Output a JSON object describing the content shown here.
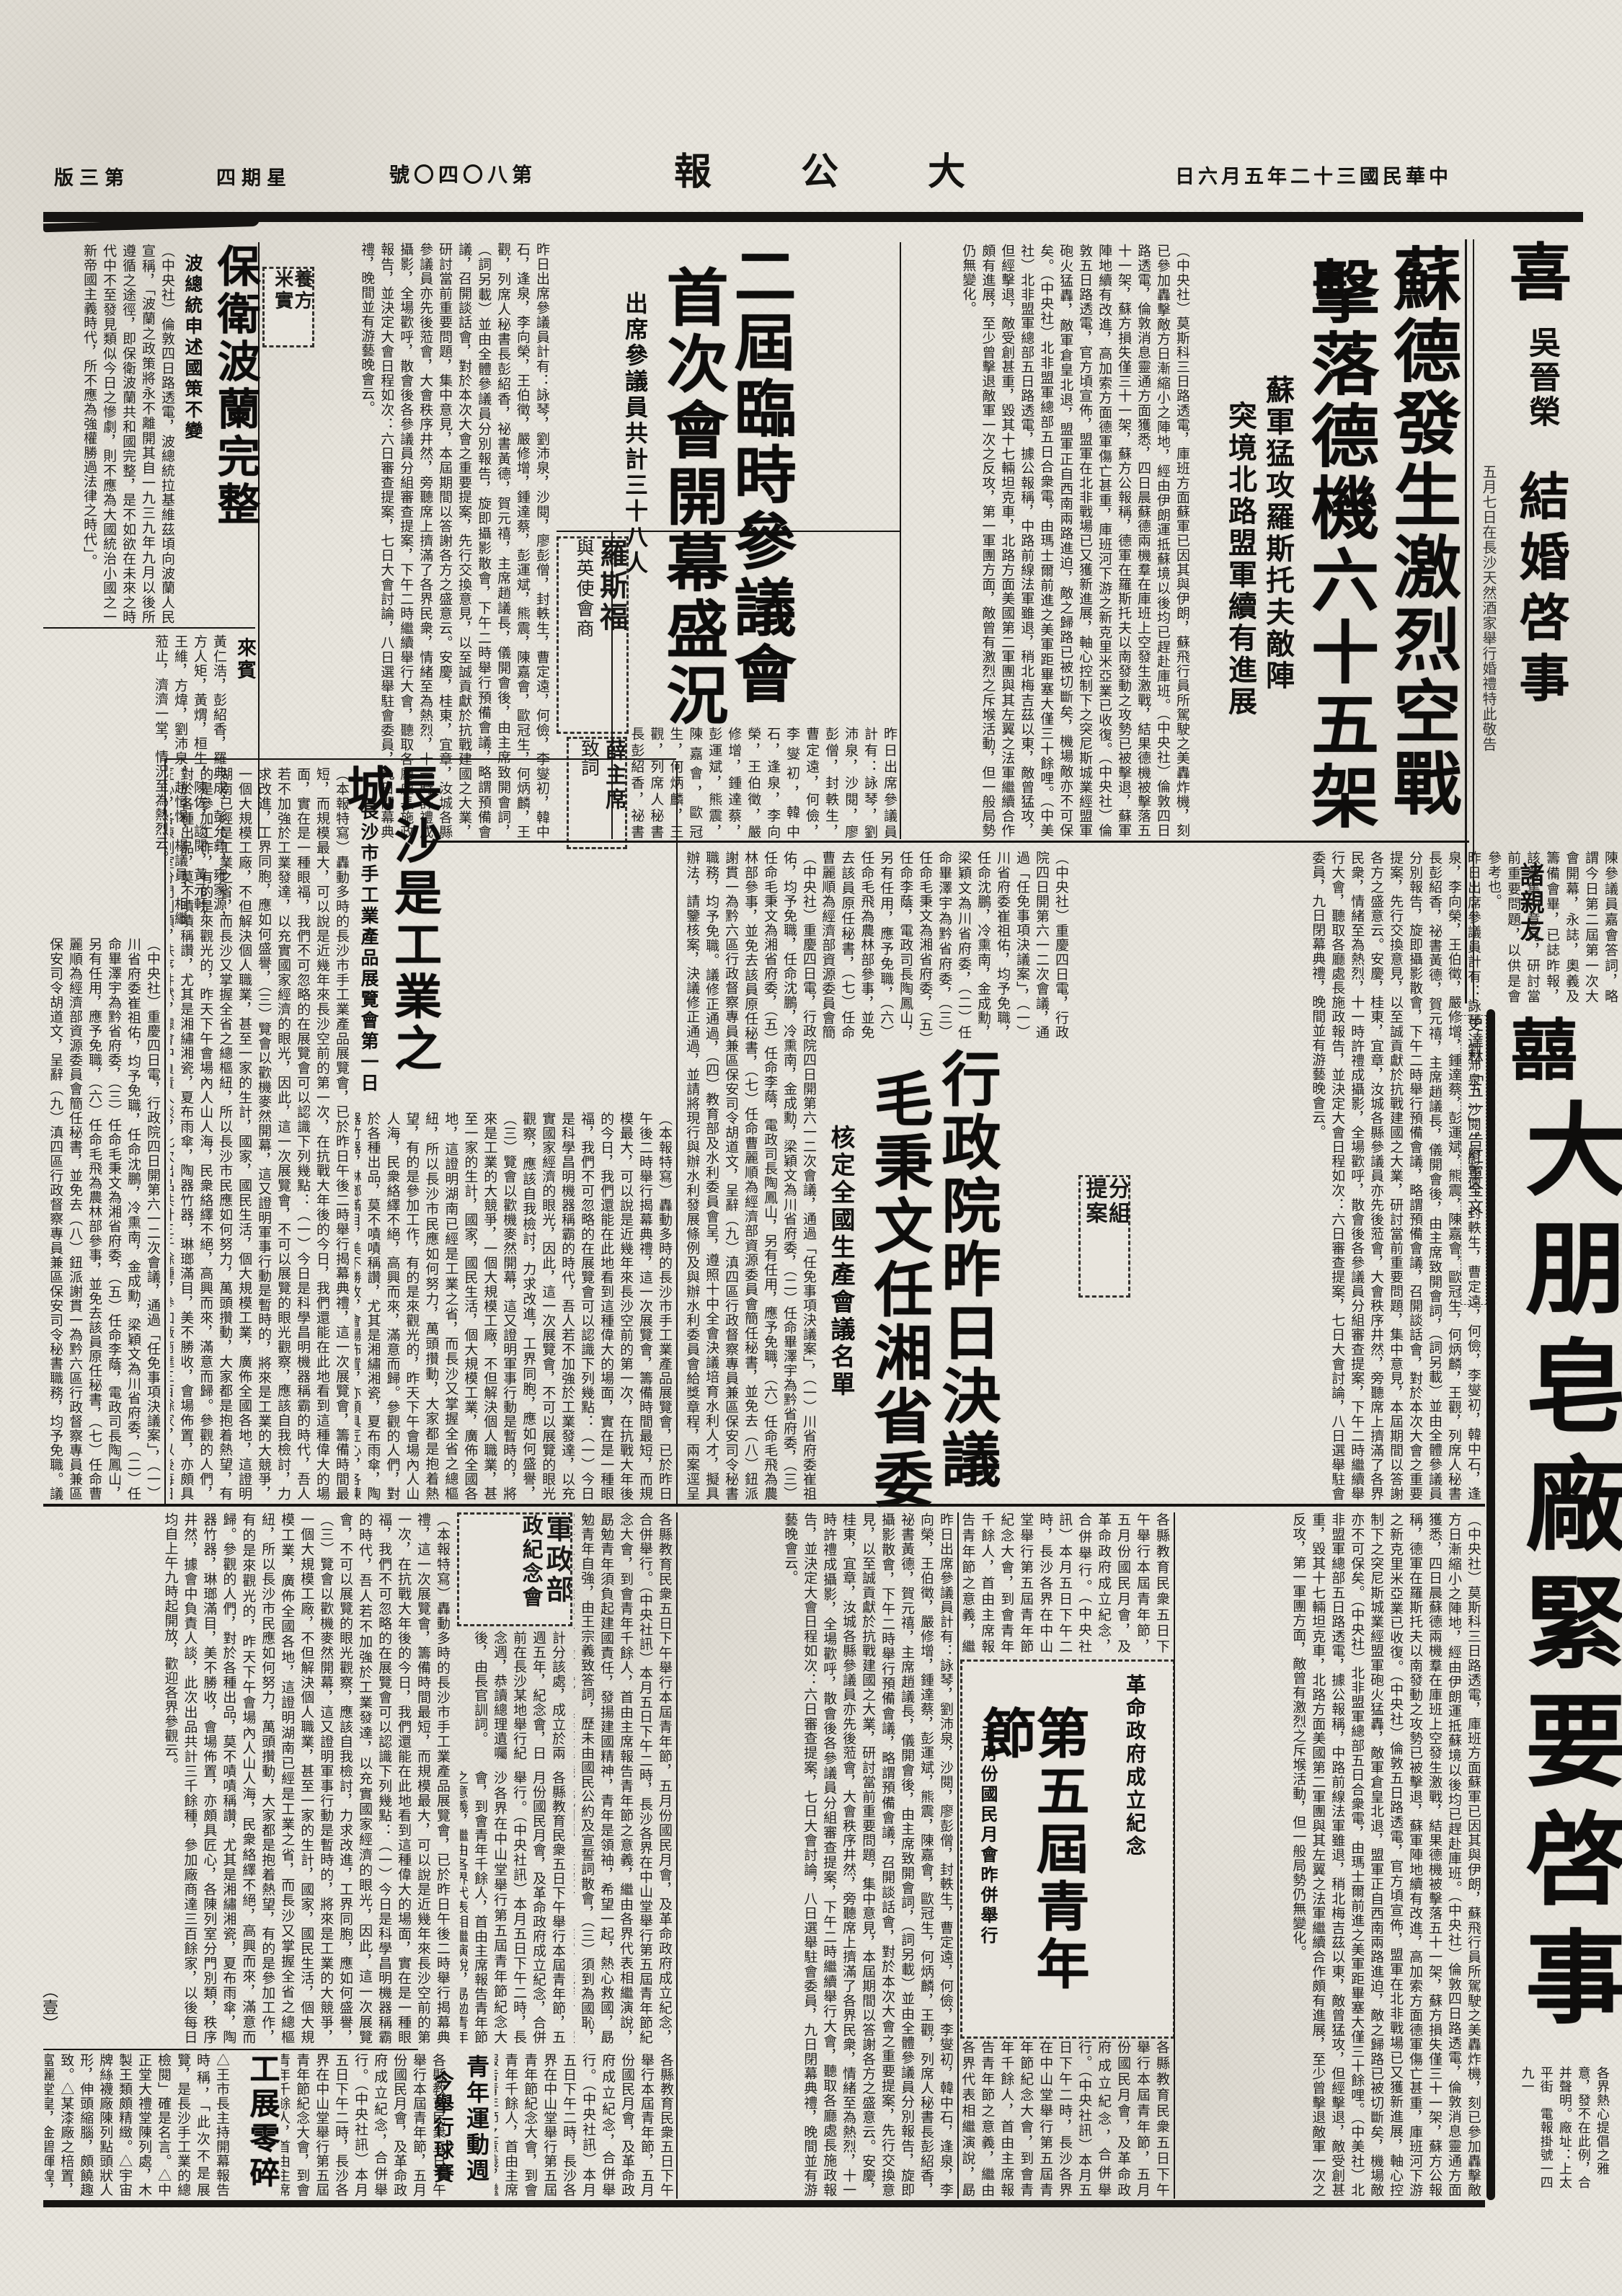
{
  "masthead": {
    "edition": "版三第",
    "weekday": "四期星",
    "issue": "號〇四〇八第",
    "title": "報　公　大",
    "date": "日六月五年二十三國民華中"
  },
  "top": {
    "wedding": {
      "joy": "喜",
      "names": "吳晉榮",
      "title": "結婚啓事",
      "note": "五月七日在長沙天然酒家舉行婚禮特此敬告",
      "addressee": "諸親友"
    },
    "sude": {
      "h1": "蘇德發生激烈空戰",
      "h2": "擊落德機六十五架",
      "sub1": "蘇軍猛攻羅斯托夫敵陣",
      "sub2": "突境北路盟軍續有進展",
      "body": "（中央社）莫斯科三日路透電，庫班方面蘇軍已因其與伊朗，蘇飛行員所駕駛之美轟炸機，刻已參加轟擊敵方日漸縮小之陣地，經由伊朗運抵蘇境以後均已趕赴庫班。（中央社）倫敦四日路透電，倫敦消息靈通方面獲悉，四日晨蘇德兩機羣在庫班上空發生激戰，結果德機被擊落五十一架，蘇方損失僅三十一架，蘇方公報稱，德軍在羅斯托夫以南發動之攻勢已被擊退，蘇軍陣地續有改進，高加索方面德軍傷亡甚重，庫班河下游之新克里米亞業已收復。（中央社）倫敦五日路透電，官方頃宣佈，盟軍在北非戰場已又獲新進展，軸心控制下之突尼斯城業經盟軍砲火猛轟，敵軍倉皇北退，盟軍正自西南兩路進迫，敵之歸路已被切斷矣，機場敵亦不可保矣。（中央社）北非盟軍總部五日合衆電，由瑪士爾前進之美軍距畢塞大僅三十餘哩。（中美社）北非盟軍總部五日路透電，據公報稱，中路前線法軍雖退，稍北梅吉茲以東，敵曾猛攻，但經擊退，敵受創甚重，毀其十七輛坦克車，北路方面美國第二軍團與其左翼之法軍繼續合作頗有進展，至少曾擊退敵軍一次之反攻，第一軍團方面，敵曾有激烈之斥堠活動，但一般局勢仍無變化。"
    },
    "council": {
      "h1": "二屆臨時參議會",
      "h2": "首次會開幕盛況",
      "sub": "出席參議員共計三十八人",
      "roosevelt1": "羅斯福",
      "roosevelt2": "與英使會商",
      "xue1": "薛主席",
      "xue2": "致詞",
      "names": "昨日出席參議員計有：詠琴，劉沛泉，沙閱，廖彭僧，封軼生，曹定遠，何儉，李燮初，韓中石，逢泉，李向榮，王伯徵，嚴修增，鍾達蔡，彭運斌，熊震，陳嘉會，歐冠生，何炳麟，王觀，列席人秘書長彭紹香，祕書黃德，賀元禧，主席趙議長，儀開會後，由主席致開會詞，（詞另載）並由全體參議員分別報告，旋即攝影散會，下午二時舉行預備會議，略謂預備會議，召開談話會，對於本次大會之重要提案，先行交換意見，以至誠貢獻於抗戰建國之大業，研討當前重要問題，集中意見，本屆期間以答謝各方之盛意云。安慶，桂東，宜章，汝城各縣參議員亦先後蒞會，大會秩序井然，旁聽席上擠滿了各界民衆，情緒至為熱烈，十一時許禮成攝影，全場歡呼，散會後各參議員分組審查提案，下午二時繼續舉行大會，聽取各廳處長施政報告，並決定大會日程如次：六日審查提案，七日大會討論，八日選舉駐會委員，九日閉幕典禮，晚間並有游藝晚會云。"
    },
    "mid_box": {
      "l1": "養方",
      "l2": "米實"
    },
    "poland": {
      "h": "保衛波蘭完整",
      "sub": "波總統申述國策不變",
      "body": "（中央社）倫敦四日路透電，波總統拉基維茲頃向波蘭人民宣稱，「波蘭之政策將永不離開其自一九三九年九月以後所遵循之途徑，即保衛波蘭共和國完整，是不如欲在未來之時代中不至發見類似今日之慘劇，則不應為大國統治小國之一新帝國主義時代，所不應為強權勝過法律之時代」。",
      "guests_label": "來賓",
      "guests": "黃仁浩，彭紹香，羅典成，彭允彝，雍家源，方人矩，黃煟，桓生，陳佐，談閱，黃元軒，王維，方煒，劉沛泉，趙恒惕，楊議員，相繼蒞止，濟濟一堂，情況至為熱烈云。"
    }
  },
  "mid": {
    "notes": "陳參議員嘉會答詞，略謂今日第二屆第一次大會開幕，永誌，奧義及籌備會畢，已誌昨報，該會集中意見，研討當前重要問題，以供是會參考也。",
    "stalin": "史達林「五一」告紅軍全文",
    "group": {
      "l1": "分組",
      "l2": "提案"
    },
    "exec": {
      "h1": "行政院昨日決議",
      "h2": "毛秉文任湘省委",
      "sub": "核定全國生產會議名單",
      "body": "（中央社）重慶四日電，行政院四日開第六一二次會議，通過「任免事項決議案」，（一）川省府委崔祖佑，均予免職，任命沈鵬，冷熏南，金成勳，梁穎文為川省府委，（二）任命畢澤宇為黔省府委，（三）任命毛秉文為湘省府委，（五）任命李蔭，電政司長陶鳳山，另有任用，應予免職，（六）任命毛飛為農林部參事，並免去該員原任秘書，（七）任命曹麗順為經濟部資源委員會簡任秘書，並免去（八）鈕派謝貫一為黔六區行政督察專員兼區保安司令胡道文，呈辭（九）滇四區行政督察專員兼區保安司令秘書職務，均予免職。議修正通過，（四）教育部及水利委員會呈，遵照十中全會決議培育水利人才，擬具辦法，請鑒核案，決議修正通過，並請將現行與辦水利發展條例及與辦水利委員會給獎章程，兩案逕呈報告，公用物保管條例草案，審核意見，請核議，修正通過。"
    },
    "changsha": {
      "h": "長沙是工業之城",
      "sub": "長沙市手工業產品展覽會第一日",
      "body": "（本報特寫）轟動多時的長沙市手工業產品展覽會，已於昨日午後二時舉行揭幕典禮，這一次展覽會，籌備時間最短，而規模最大，可以說是近幾年來長沙空前的第一次，在抗戰大年後的今日，我們還能在此地看到這種偉大的場面，實在是一種眼福，我們不可忽略的在展覽會可以認識下列幾點：（一）今日是科學昌明機器稱霸的時代，吾人若不加強於工業發達，以充實國家經濟的眼光，因此，這一次展覽會，不可以展覽的眼光觀察，應該自我檢討，力求改進，工界同胞，應如何盛譽，（三）覽會以歡機麥然開幕，這又證明軍事行動是暫時的，將來是工業的大競爭，一個大規模工廠，不但解決個人職業，甚至一家的生計，國家，國民生活，個大規模工業，廣佈全國各地，這證明湖南已經是工業之省，而長沙又掌握全省之總樞紐，所以長沙市民應如何努力，萬頭攢動，大家都是抱着熱望，有的是參加工作，有的是來觀光的，昨天下午會場內人山人海，民衆絡繹不絕，高興而來，滿意而歸。參觀的人們，對於各種出品，莫不嘖嘖稱讚，尤其是湘繡湘瓷，夏布雨傘，陶器竹器，琳瑯滿目，美不勝收，會場佈置，亦頗具匠心，各陳列室分門別類，秩序井然，據會中負責人談，此次出品共計三千餘種，參加廠商達三百餘家，以後每日均自上午九時起開放，歡迎各界參觀云。"
    }
  },
  "bottom": {
    "military": {
      "l1": "軍政部",
      "l2": "政紀念會",
      "body": "計分該處，成立於兩週五年，紀念會，日前在長沙某地舉行紀念週，恭讀總理遺囑後，由長官訓詞。"
    },
    "youth": {
      "tag": "革命政府成立紀念",
      "h": "第五屆青年節",
      "sub": "五月份國民月會昨併舉行",
      "body": "各縣教育民衆五日下午舉行本屆青年節，五月份國民月會，及革命政府成立紀念，合併舉行。（中央社訊）本月五日下午二時，長沙各界在中山堂舉行第五屆青年節紀念大會，到會青年千餘人，首由主席報告青年節之意義，繼由各界代表相繼演說，勗勉青年須負起建國責任，發揚建國精神，青年是領袖，希望一起，熱心救國，勗勉青年自強，由王宗義致答詞，歷未由國民公約及宣誓詞散會，（三）須到為國恥，家爭主人，推定王伯毅，斌，黑益大參議員賦問題，並擬本月，推定，競賽者，報名隊，有麓西諸隊，青年會民，是日下午二時在俱樂部操坪（或青年會操坪）舉行籃球預賽，七日決賽云。"
    },
    "gongzhan": {
      "h": "工展零碎",
      "body": "△王市長主持開幕報告時稱，「此次不是展覽，是長沙手工業的總檢閱」確是名言。△中正堂大禮堂陳列處，木製王類頗精緻。△宇宙牌絲襪廠陳列點頭狀人形，伸頭縮腦，頗饒趣致。△某漆廠之棓置，富麗堂皇，金碧輝煌，鴛鴦鴨子二類。"
    },
    "sports": {
      "h1": "青年運動週",
      "h2": "今舉行球賽"
    },
    "page_marker": "（壹）"
  },
  "ads": {
    "soap": {
      "joy": "囍",
      "chars": "大朋皂廠緊要啓事",
      "note": "各界熱心提倡之雅意，發不在此例，合并聲明。廠址：上太平街　電報掛號一四九一"
    }
  },
  "colors": {
    "paper": "#e8e5dd",
    "ink": "#1b1a18"
  }
}
